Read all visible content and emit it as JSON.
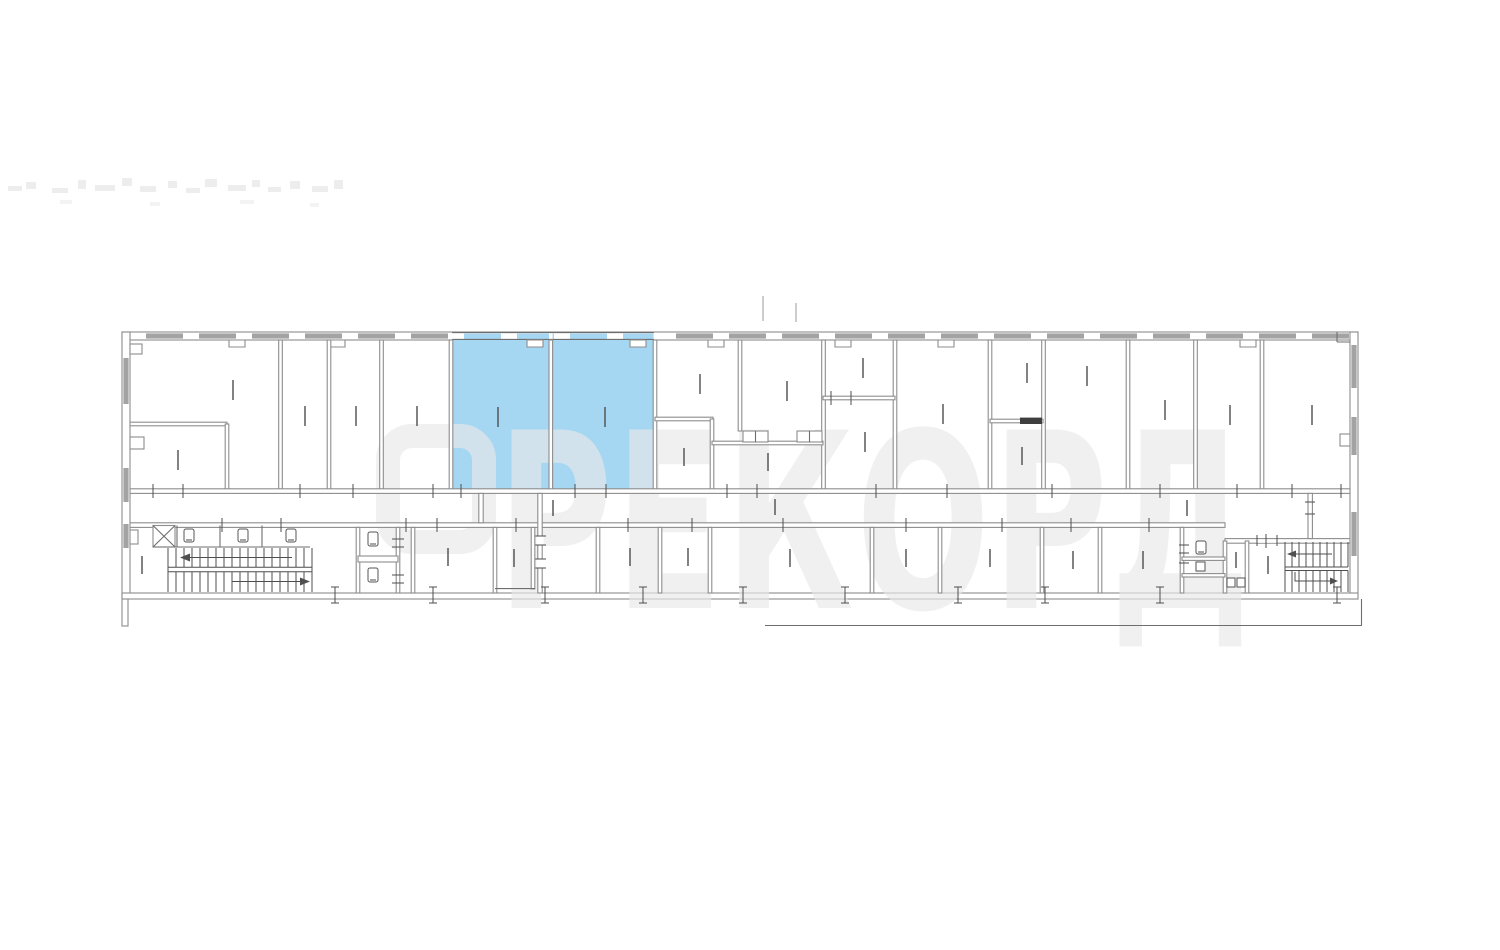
{
  "watermark": {
    "text": "РЕКОРД",
    "logo_icon": "rounded-square-logo-icon"
  },
  "colors": {
    "background": "#ffffff",
    "highlight": "#a5d6f2",
    "wall": "#6e6e6e",
    "partition": "#8d8d8d",
    "window_fill": "#a3a3a3",
    "watermark_fill": "#e9e9e9",
    "tick": "#4e4e4e",
    "door_leaf": "#3f3f3f"
  },
  "plan": {
    "type": "building-floor-plan",
    "highlighted_rooms": [
      "left-highlighted-room",
      "right-highlighted-room"
    ],
    "features": [
      "stairs-left",
      "stairs-right",
      "elevator",
      "wc-fixtures",
      "corridor",
      "windows"
    ]
  }
}
